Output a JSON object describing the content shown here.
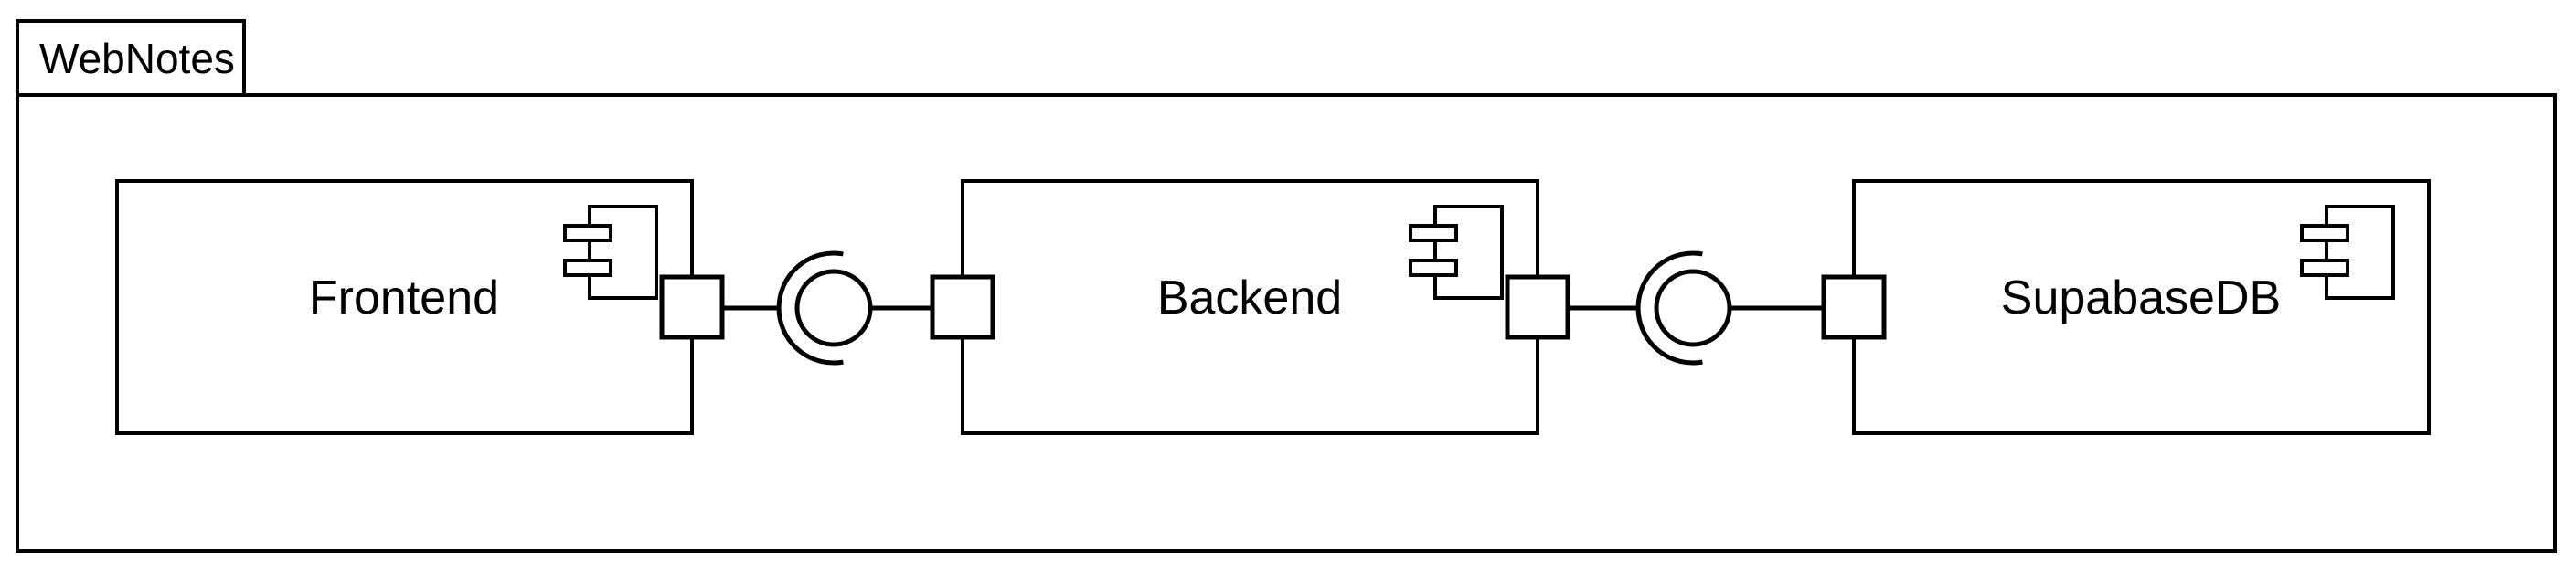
{
  "package": {
    "label": "WebNotes"
  },
  "components": [
    {
      "label": "Frontend"
    },
    {
      "label": "Backend"
    },
    {
      "label": "SupabaseDB"
    }
  ],
  "icons": {
    "component_icon": "uml-component-glyph",
    "ball_interface": "provided-interface-ball",
    "socket_interface": "required-interface-socket",
    "port": "uml-port-square"
  },
  "colors": {
    "stroke": "#000000",
    "background": "#ffffff"
  }
}
